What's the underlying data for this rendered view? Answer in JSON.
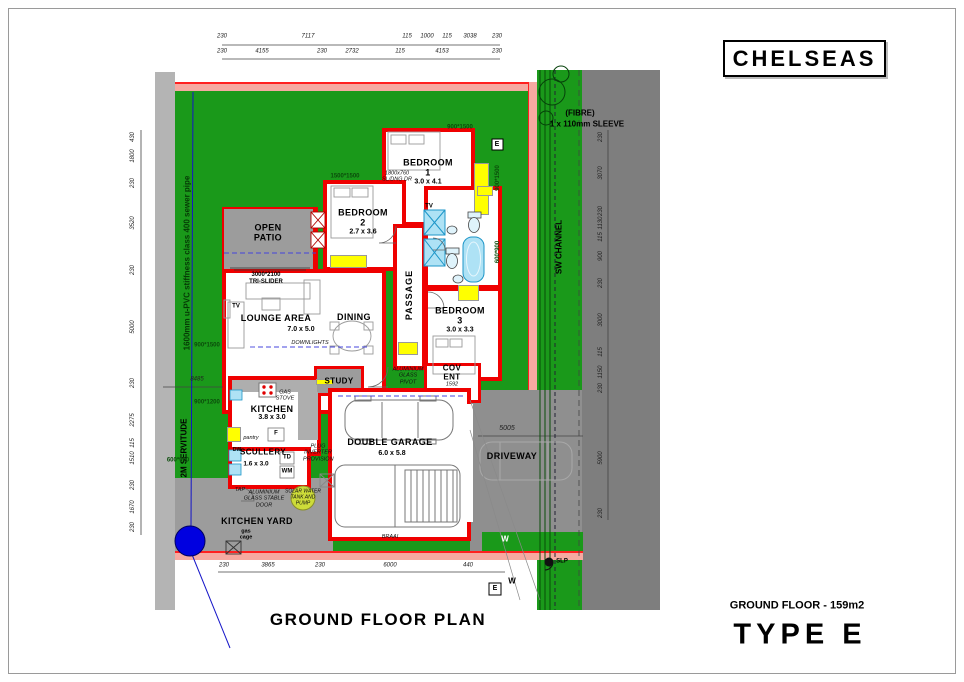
{
  "title_block": {
    "name": "CHELSEAS"
  },
  "footer": {
    "plan_title": "GROUND FLOOR PLAN",
    "area_label": "GROUND FLOOR - 159m2",
    "type_label": "TYPE E"
  },
  "rooms": {
    "bedroom1": {
      "name": "BEDROOM",
      "number": "1",
      "size": "3.0 x 4.1"
    },
    "bedroom2": {
      "name": "BEDROOM",
      "number": "2",
      "size": "2.7 x 3.6"
    },
    "bedroom3": {
      "name": "BEDROOM",
      "number": "3",
      "size": "3.0 x 3.3"
    },
    "lounge": {
      "name": "LOUNGE AREA",
      "size": "7.0 x 5.0"
    },
    "dining": {
      "name": "DINING"
    },
    "open_patio": {
      "line1": "OPEN",
      "line2": "PATIO"
    },
    "passage": {
      "name": "PASSAGE"
    },
    "kitchen": {
      "name": "KITCHEN",
      "size": "3.8 x 3.0"
    },
    "scullery": {
      "name": "SCULLERY",
      "size": "1.6 x 3.0"
    },
    "study": {
      "name": "STUDY"
    },
    "cov_ent": {
      "line1": "COV",
      "line2": "ENT",
      "dim": "1592"
    },
    "garage": {
      "name": "DOUBLE GARAGE",
      "size": "6.0 x 5.8"
    },
    "driveway": {
      "name": "DRIVEWAY"
    },
    "kitchen_yard": {
      "name": "KITCHEN YARD"
    }
  },
  "annotations": {
    "tri1": "3000*2100",
    "tri2": "TRI-SLIDER",
    "downlights": "DOWNLIGHTS",
    "tv": "TV",
    "gas_stove": "GAS STOVE",
    "pantry": "pantry",
    "fridge": "F",
    "td": "TD",
    "wm": "WM",
    "dw": "DW",
    "tap": "TAP",
    "stable_door": "ALUMINIUM GLASS STABLE DOOR",
    "solar": "SOLAR WATER TANK AND PUMP",
    "inverter": "PLUG INVERTER PROVISION",
    "pivot": "ALUMINIUM GLASS PIVOT",
    "sliding": "1800x760 SL/DNG DR",
    "gas_cage1": "gas",
    "gas_cage2": "cage",
    "braai": "BRAAI",
    "servitude": "2M SERVITUDE",
    "sewer": "1600mm u-PVC stiffness class 400 sewer pipe",
    "sw_channel": "SW CHANNEL",
    "fibre1": "(FIBRE)",
    "fibre2": "1 x 110mm SLEEVE",
    "slp": "SLP",
    "e_meter": "E",
    "w_meter": "W"
  },
  "window_labels": {
    "w900x1500": "900*1500",
    "w1500x1500": "1500*1500",
    "w900x1200": "900*1200",
    "w600x900": "600*900"
  },
  "dims": {
    "top1": [
      "230",
      "7117",
      "115",
      "1000",
      "115",
      "3038",
      "230"
    ],
    "top2": [
      "230",
      "4155",
      "230",
      "2732",
      "115",
      "4153",
      "230"
    ],
    "bottom": [
      "230",
      "3865",
      "230",
      "6000",
      "440"
    ],
    "left": [
      "430",
      "1800",
      "230",
      "3520",
      "230",
      "5000",
      "230",
      "2275",
      "115",
      "1510",
      "230",
      "1670",
      "230"
    ],
    "right": [
      "230",
      "3070",
      "230",
      "1130",
      "115",
      "900",
      "230",
      "3000",
      "115",
      "1150",
      "230",
      "5900",
      "230"
    ],
    "yard": "8485",
    "drive": "5005"
  }
}
